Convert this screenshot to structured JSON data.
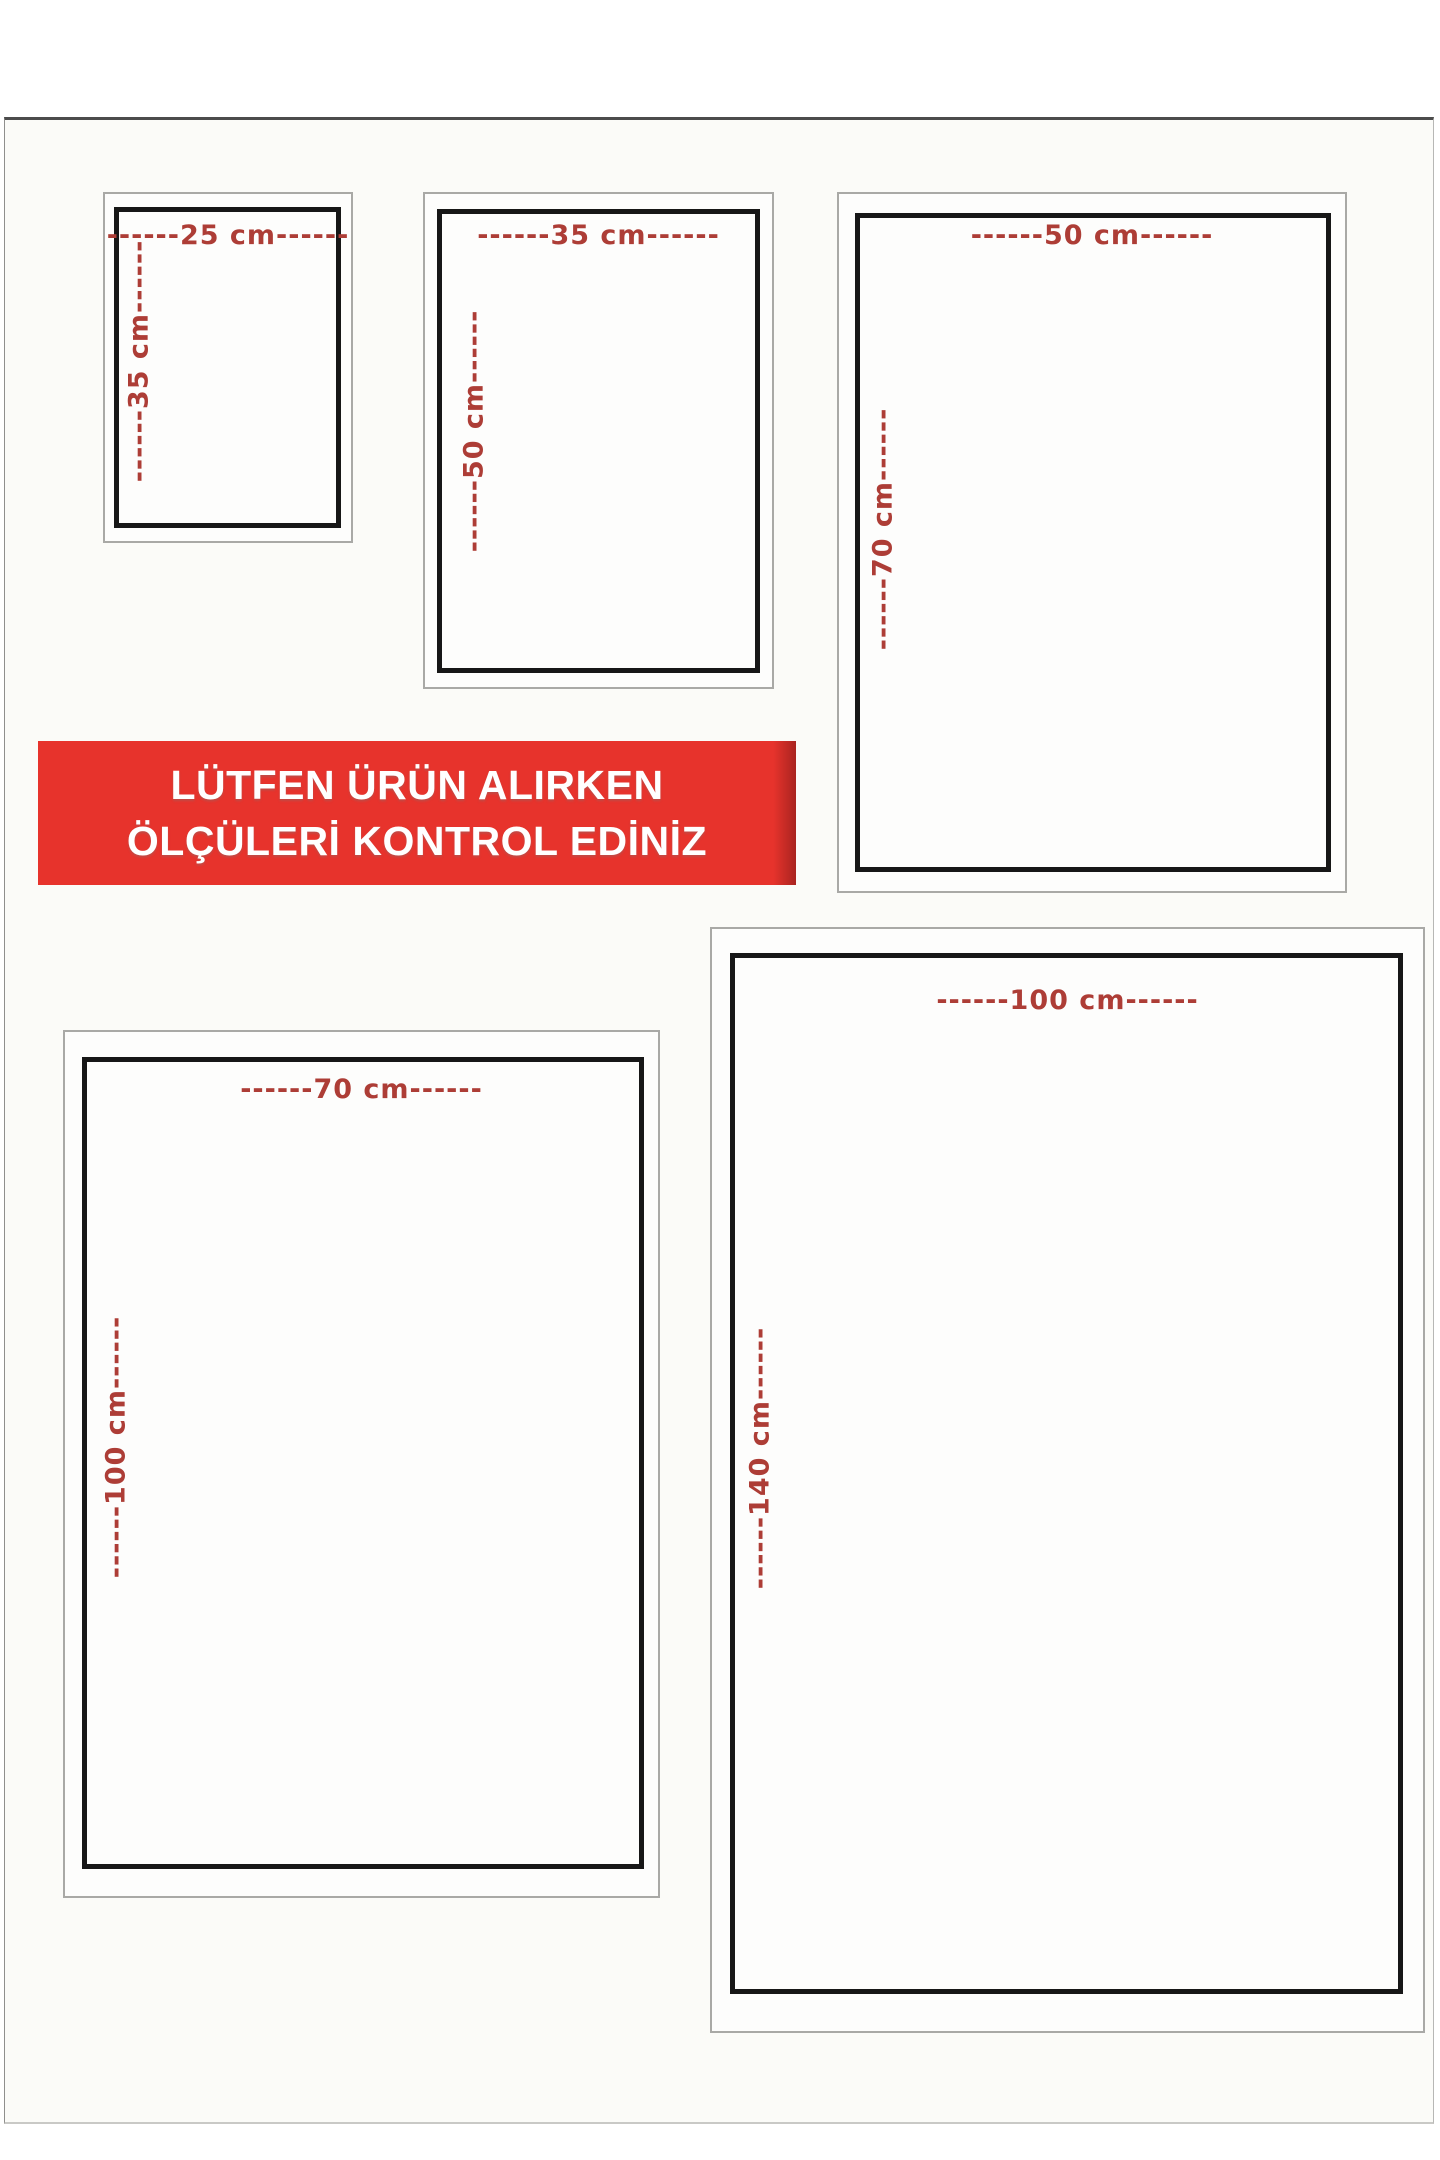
{
  "banner": {
    "line1": "LÜTFEN ÜRÜN ALIRKEN",
    "line2": "ÖLÇÜLERİ KONTROL EDİNİZ",
    "background_color": "#e7332c",
    "text_color": "#ffffff"
  },
  "colors": {
    "dimension_label_red": "#ad3d36",
    "inner_frame_black": "#171717",
    "outer_frame_gray": "#a9a9a6",
    "page_background": "#fbfbf8"
  },
  "boxes": [
    {
      "name": "25x35",
      "width_cm": 25,
      "height_cm": 35,
      "width_label": "------25 cm------",
      "height_label": "------35 cm------"
    },
    {
      "name": "35x50",
      "width_cm": 35,
      "height_cm": 50,
      "width_label": "------35 cm------",
      "height_label": "------50 cm------"
    },
    {
      "name": "50x70",
      "width_cm": 50,
      "height_cm": 70,
      "width_label": "------50 cm------",
      "height_label": "------70 cm------"
    },
    {
      "name": "70x100",
      "width_cm": 70,
      "height_cm": 100,
      "width_label": "------70 cm------",
      "height_label": "------100 cm------"
    },
    {
      "name": "100x140",
      "width_cm": 100,
      "height_cm": 140,
      "width_label": "------100 cm------",
      "height_label": "------140 cm------"
    }
  ]
}
